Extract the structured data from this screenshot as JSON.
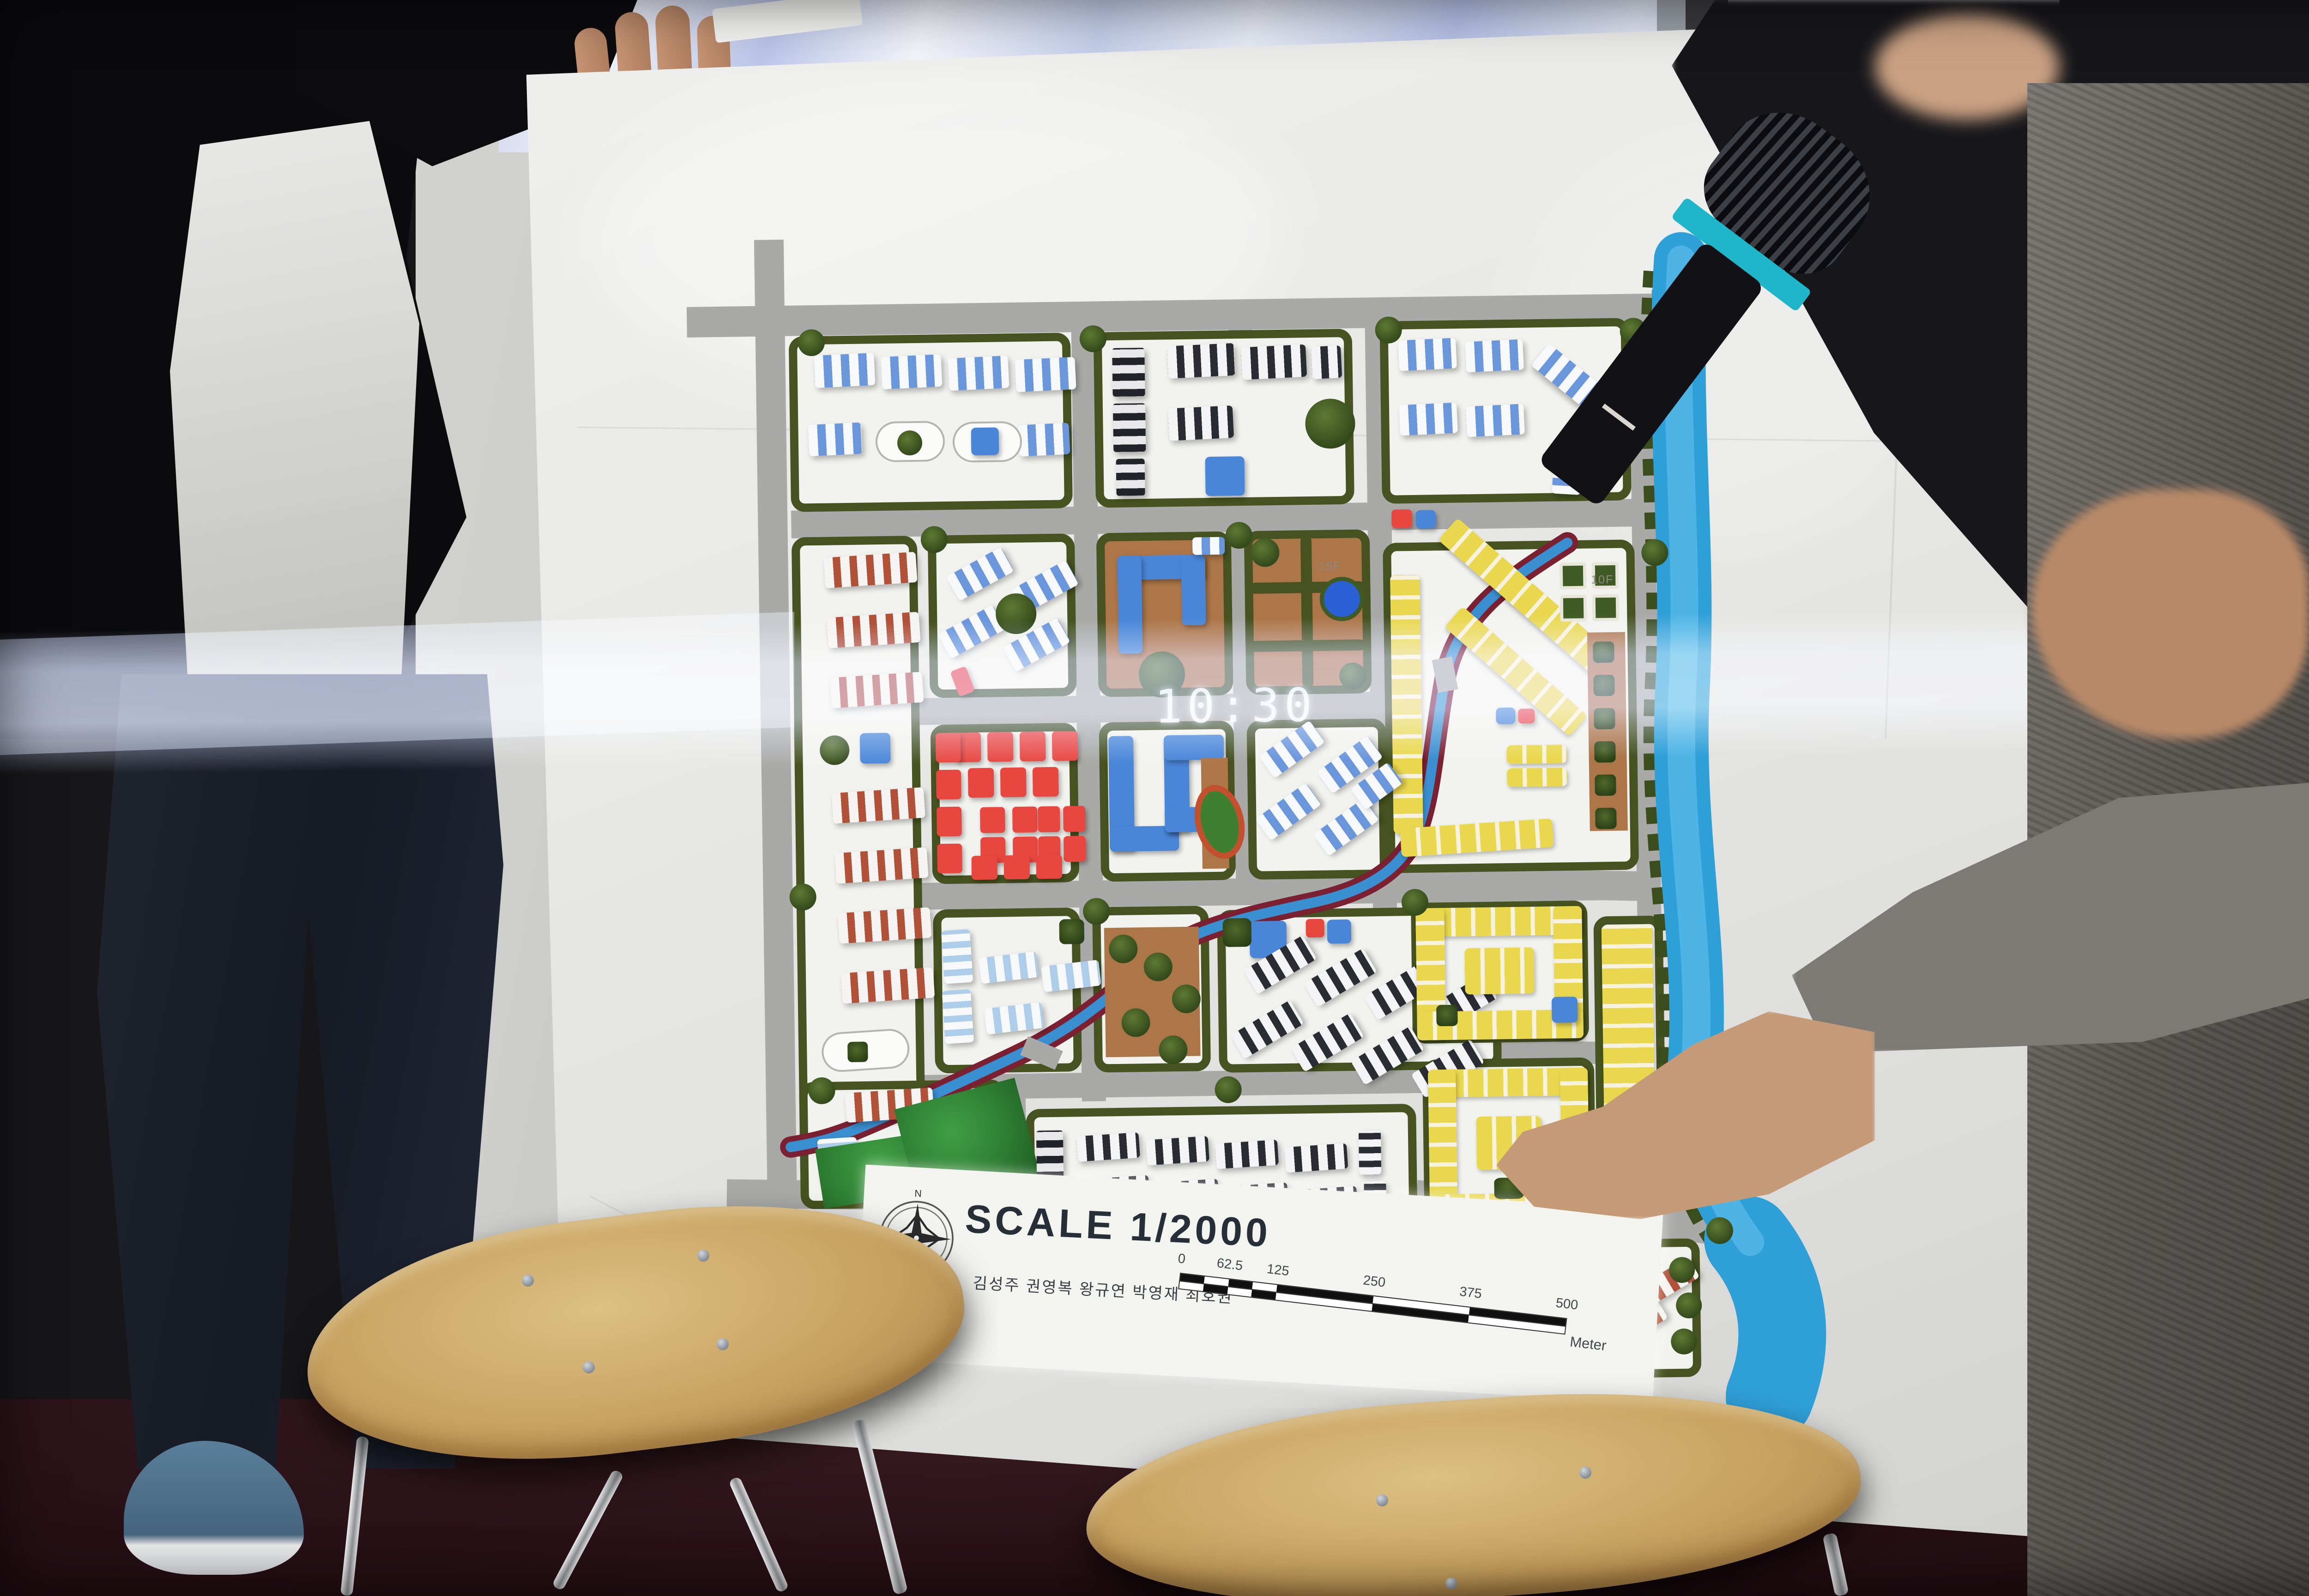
{
  "board": {
    "title": {
      "scale_label": "SCALE 1/2000"
    },
    "credits": "김성주 권영복 왕규연 박영재 최호권",
    "compass": {
      "north_label": "N"
    },
    "scalebar": {
      "ticks": [
        "0",
        "62.5",
        "125",
        "250",
        "375",
        "500"
      ],
      "unit": "Meter"
    },
    "map": {
      "labels": {
        "floor_label_a": "15F",
        "floor_label_b": "10F"
      }
    }
  },
  "projection": {
    "clock_text": "10:30"
  },
  "colors": {
    "road": "#a9a9a7",
    "hedge": "#46521f",
    "river": "#2f9fd8",
    "yellow_house": "#e9d84e",
    "red_block": "#e8473f",
    "blue_building": "#4a86d8",
    "brown": "#ad7648",
    "mic_band": "#1fb6c9",
    "projector_band": "#cdd6fa"
  }
}
